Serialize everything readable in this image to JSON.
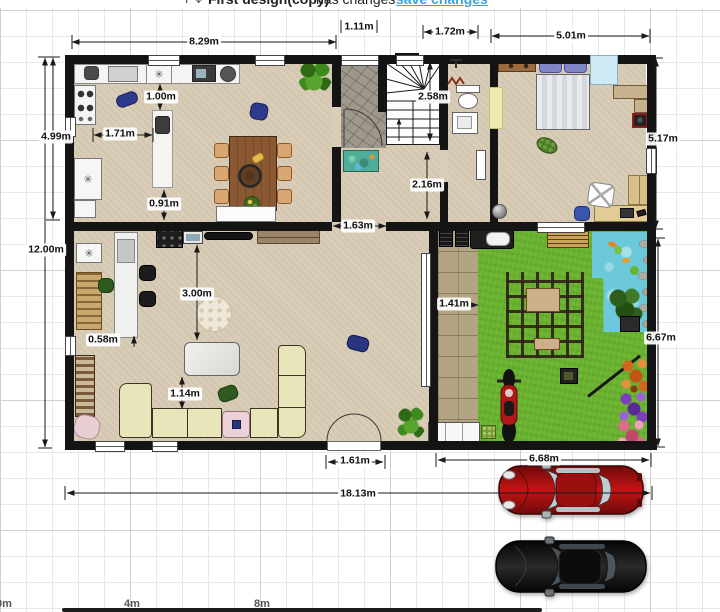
{
  "header": {
    "pan_icon": "✛",
    "zoom_icon": "✥",
    "title": "First design(copy)",
    "status": "has changes",
    "save_link": "save changes"
  },
  "dimensions": {
    "top_width": "8.29m",
    "front_door": "1.11m",
    "stair_top": "1.72m",
    "bedroom_width": "5.01m",
    "kitchen_height": "4.99m",
    "total_height": "12.00m",
    "island_top": "1.00m",
    "island_left": "1.71m",
    "island_bottom": "0.91m",
    "staircase": "2.58m",
    "hallway": "2.16m",
    "wall_opening": "1.63m",
    "path_width": "1.41m",
    "bedroom_height": "5.17m",
    "garden_height": "6.67m",
    "bar_gap": "0.58m",
    "rug_gap": "3.00m",
    "sofa_gap": "1.14m",
    "patio_door": "1.61m",
    "garden_width": "6.68m",
    "total_width": "18.13m"
  },
  "scale": {
    "labels": [
      "0m",
      "4m",
      "8m"
    ]
  },
  "symbols": {
    "snowflake": "✳"
  },
  "colors": {
    "wall": "#141414",
    "floor": "#d9cdb8",
    "grass": "#6ab32e",
    "pond": "#6cc9da",
    "path": "#b3a483",
    "sofa": "#e9e5ba",
    "link": "#3ba3d6",
    "car_red": "#a01010",
    "car_black": "#141414",
    "stone": "#9e978c"
  }
}
